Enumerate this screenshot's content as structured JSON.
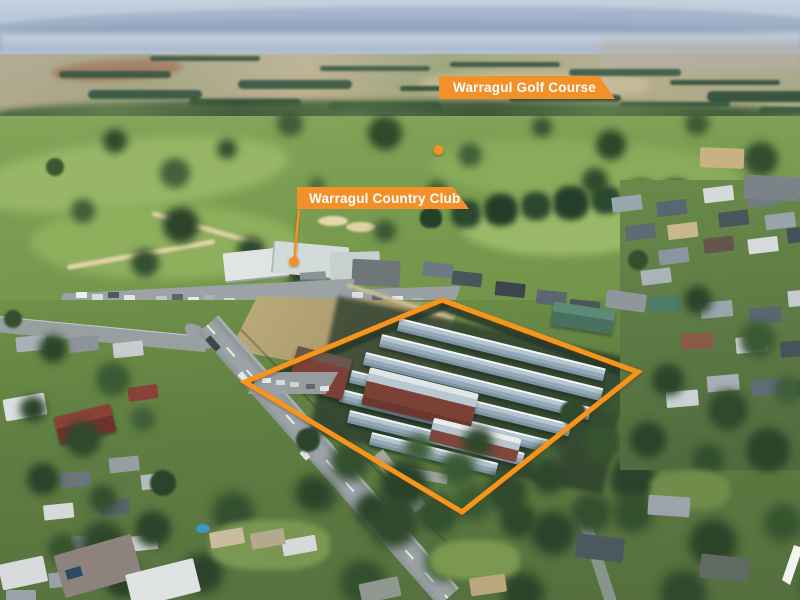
{
  "meta": {
    "type": "annotated-aerial-photograph",
    "subject": "Warragul property listing aerial view",
    "width_px": 800,
    "height_px": 600
  },
  "annotations": {
    "accent_color": "#F2902A",
    "labels": [
      {
        "id": "golf-course",
        "text": "Warragul Golf Course",
        "pointer": "vertical line down to orange dot"
      },
      {
        "id": "country-club",
        "text": "Warragul Country Club",
        "pointer": "line down to orange dot"
      }
    ],
    "property_boundary": {
      "shape": "quadrilateral",
      "points": "442,300 638,372 462,512 245,382",
      "stroke_color": "#F7941E",
      "stroke_width": 5
    },
    "watermark": {
      "description": "partial white logo slash clipped at right edge",
      "color": "#FFFFFF"
    }
  },
  "scene": {
    "description": "Oblique drone photo: hazy blue mountain horizon, patchwork farmland, golf course fairways and tree clusters, country club building with busy car park, school campus of parallel grey roof rows and brick buildings inside the orange boundary, diagonal road along the site, residential streets with varied rooftops below and to the right.",
    "palette": {
      "sky_haze": "#AEBDD0",
      "mountains": "#7A90AD",
      "farmland": "#B0A687",
      "fairway": "#8EB05D",
      "trees": "#33502E",
      "roads": "#9AA1A4",
      "school_roofs": "#9FB4C2",
      "brick_walls": "#7C4136"
    }
  }
}
